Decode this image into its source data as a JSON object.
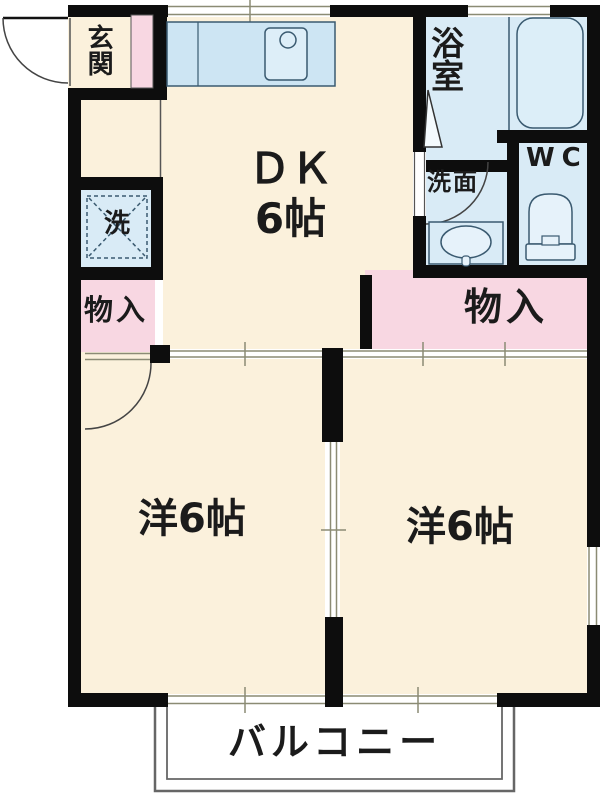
{
  "plan": {
    "type": "apartment-floorplan",
    "rooms": {
      "genkan": {
        "label": "玄関"
      },
      "dk": {
        "label": "ＤＫ",
        "size": "6帖"
      },
      "bathroom": {
        "label": "浴室"
      },
      "washroom": {
        "label": "洗面"
      },
      "toilet": {
        "label": "WC"
      },
      "laundry": {
        "label": "洗"
      },
      "closet_left": {
        "label": "物入"
      },
      "closet_right": {
        "label": "物入"
      },
      "western_room_left": {
        "label": "洋6帖"
      },
      "western_room_right": {
        "label": "洋6帖"
      },
      "balcony": {
        "label": "バルコニー"
      }
    },
    "colors": {
      "floor_cream": "#fbf1dc",
      "wet_area_blue": "#d9ebf6",
      "closet_pink": "#f8d7e2",
      "wall_black": "#0d0d0d",
      "track_olive": "#8b8b74",
      "balcony_gray": "#666666"
    }
  }
}
